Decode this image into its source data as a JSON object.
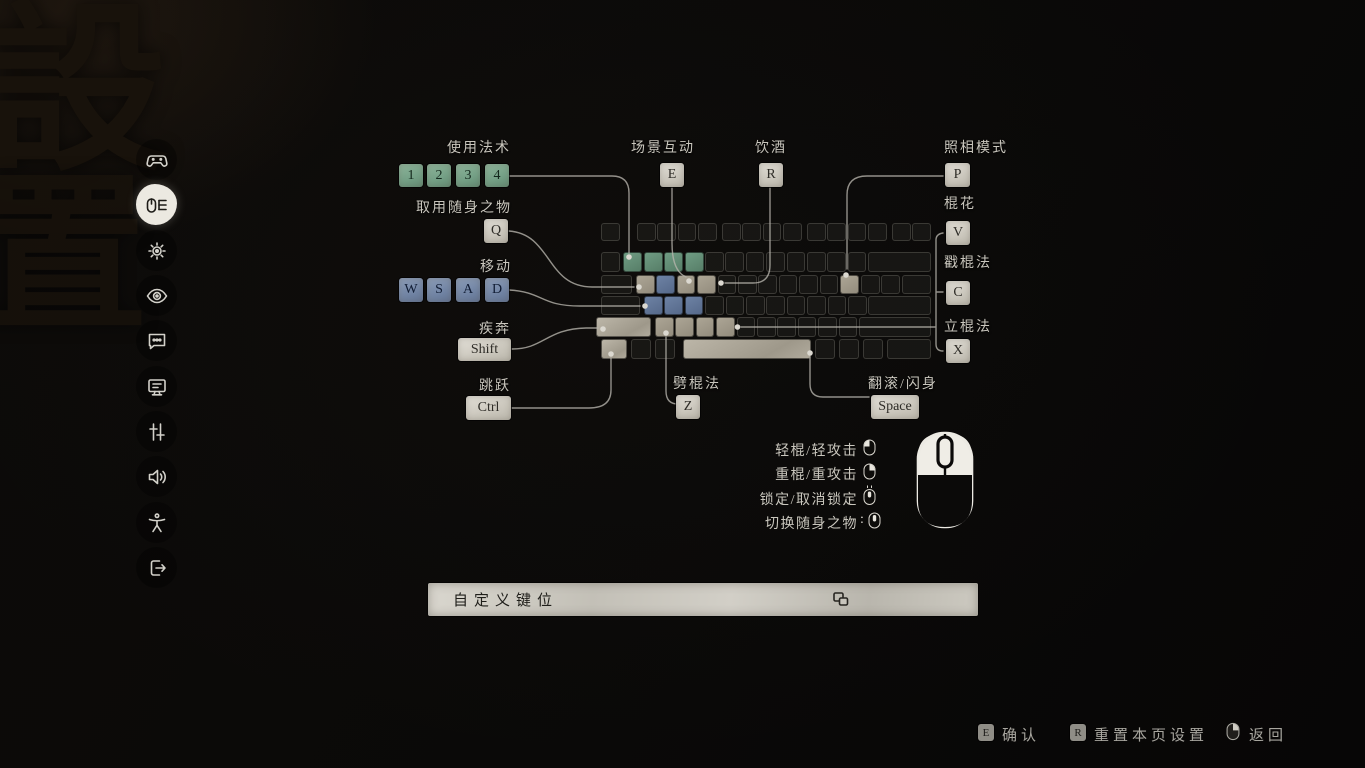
{
  "page": {
    "calligraphy": [
      "設",
      "置"
    ]
  },
  "sidebar": {
    "active_index": 1,
    "items": [
      {
        "icon": "gamepad-icon"
      },
      {
        "icon": "keyboard-mouse-icon"
      },
      {
        "icon": "gear-icon"
      },
      {
        "icon": "eye-icon"
      },
      {
        "icon": "subtitles-chat-icon"
      },
      {
        "icon": "monitor-icon"
      },
      {
        "icon": "sliders-icon"
      },
      {
        "icon": "speaker-icon"
      },
      {
        "icon": "accessibility-icon"
      },
      {
        "icon": "exit-icon"
      }
    ]
  },
  "bindings": {
    "spells": {
      "label": "使用法术",
      "keys": [
        "1",
        "2",
        "3",
        "4"
      ]
    },
    "item": {
      "label": "取用随身之物",
      "key": "Q"
    },
    "move": {
      "label": "移动",
      "keys": [
        "W",
        "S",
        "A",
        "D"
      ]
    },
    "sprint": {
      "label": "疾奔",
      "key": "Shift"
    },
    "jump": {
      "label": "跳跃",
      "key": "Ctrl"
    },
    "interact": {
      "label": "场景互动",
      "key": "E"
    },
    "drink": {
      "label": "饮酒",
      "key": "R"
    },
    "photo": {
      "label": "照相模式",
      "key": "P"
    },
    "flourish": {
      "label": "棍花",
      "key": "V"
    },
    "thrust": {
      "label": "戳棍法",
      "key": "C"
    },
    "pillar": {
      "label": "立棍法",
      "key": "X"
    },
    "smash": {
      "label": "劈棍法",
      "key": "Z"
    },
    "dodge": {
      "label": "翻滚/闪身",
      "key": "Space"
    }
  },
  "mouse_bindings": [
    {
      "label": "轻棍/轻攻击",
      "icon": "mouse-left-click-icon",
      "prefix": ""
    },
    {
      "label": "重棍/重攻击",
      "icon": "mouse-right-click-icon",
      "prefix": ""
    },
    {
      "label": "锁定/取消锁定",
      "icon": "mouse-middle-click-icon",
      "prefix": ""
    },
    {
      "label": "切换随身之物",
      "icon": "mouse-scroll-icon",
      "prefix": ":"
    }
  ],
  "custom_button": {
    "label": "自定义键位",
    "icon": "overlap-windows-icon"
  },
  "footer": {
    "confirm": {
      "key": "E",
      "label": "确认"
    },
    "reset": {
      "key": "R",
      "label": "重置本页设置"
    },
    "back": {
      "label": "返回",
      "icon": "mouse-right-click-icon"
    }
  },
  "colors": {
    "accent_green": "#74A086",
    "accent_blue": "#7285A5",
    "key_stone": "#D6D3CA",
    "text": "#C9C6BD",
    "background": "#0A0908"
  }
}
